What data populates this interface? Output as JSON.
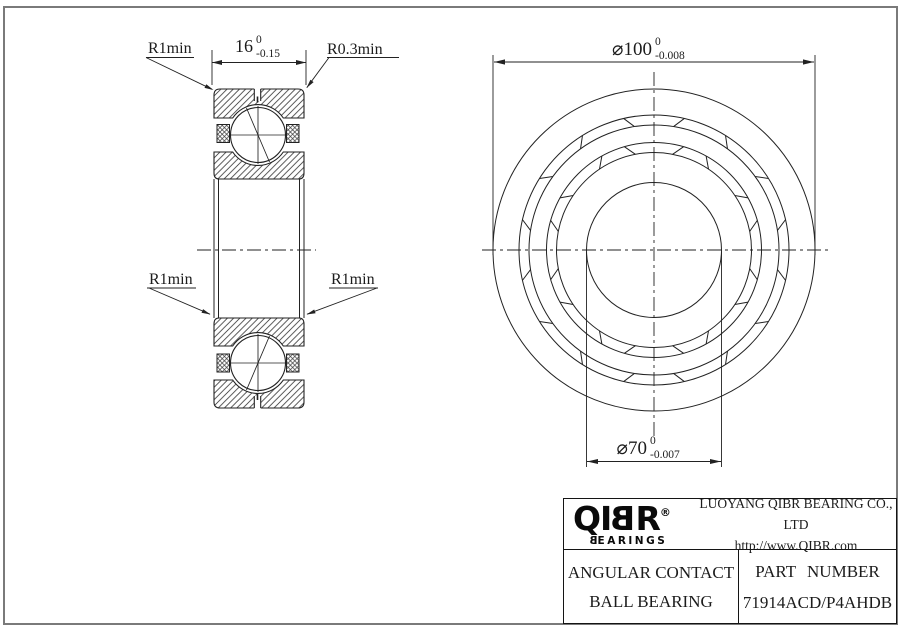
{
  "page": {
    "background": "#ffffff",
    "border_color": "#7a7a7a",
    "line_color": "#222222"
  },
  "section_view": {
    "labels": {
      "top_left": "R1min",
      "top_right": "R0.3min",
      "mid_left": "R1min",
      "mid_right": "R1min"
    },
    "width_dim": {
      "value": "16",
      "tol_upper": "0",
      "tol_lower": "-0.15"
    }
  },
  "front_view": {
    "od_dim": {
      "value": "⌀100",
      "tol_upper": "0",
      "tol_lower": "-0.008"
    },
    "bore_dim": {
      "value": "⌀70",
      "tol_upper": "0",
      "tol_lower": "-0.007"
    }
  },
  "title_block": {
    "brand": {
      "prefix": "QI",
      "flipped_letter": "B",
      "suffix": "R",
      "registered": "®",
      "tagline_flipped": "B",
      "tagline_rest": "EARINGS"
    },
    "company": "LUOYANG QIBR BEARING CO., LTD",
    "website": "http://www.QIBR.com",
    "product_line1": "ANGULAR CONTACT",
    "product_line2": "BALL BEARING",
    "part_label": "PART NUMBER",
    "part_number": "71914ACD/P4AHDB"
  }
}
